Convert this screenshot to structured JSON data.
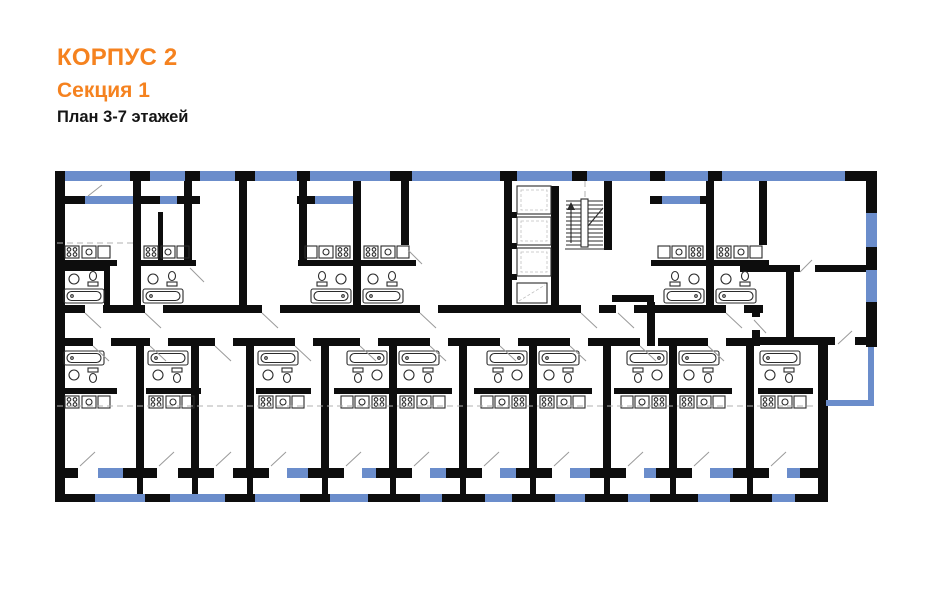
{
  "header": {
    "building": "КОРПУС 2",
    "section": "Секция 1",
    "floors": "План 3-7 этажей"
  },
  "colors": {
    "accent": "#F5821F",
    "wall": "#0D0D0D",
    "window": "#6B8DCB",
    "background": "#FFFFFF",
    "fixture": "#2B2B2B",
    "door": "#9A9A9A",
    "guide": "#B0B0B0"
  },
  "plan": {
    "title": "floor-plan-building-2-section-1",
    "features": [
      "exterior-walls",
      "interior-walls",
      "window-glazing",
      "balconies",
      "loggias",
      "central-corridor",
      "staircase",
      "elevator-shafts",
      "door-swings",
      "bathtub-icons",
      "sink-icons",
      "toilet-icons",
      "stove-icons",
      "kitchen-counters"
    ]
  }
}
